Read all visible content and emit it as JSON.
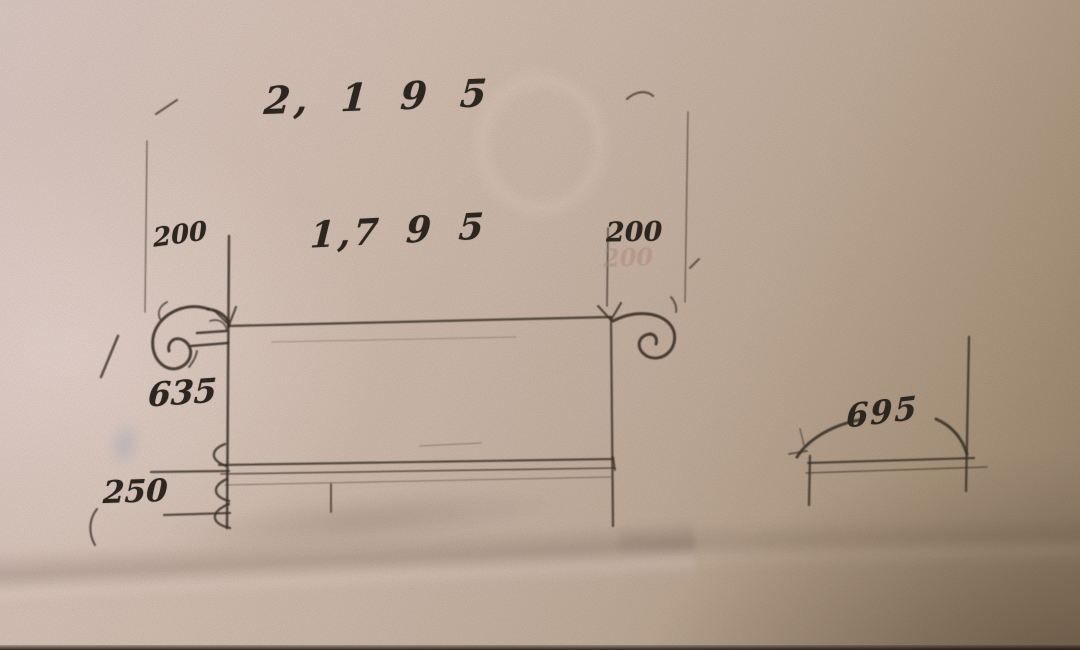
{
  "photo": {
    "type": "hand-drawn pencil sketch of a dimensioned drawing on paper",
    "paper_base_color": "#d2bdae",
    "pencil_color": "#3b322a",
    "ink_color": "#2c2620",
    "smudge_color": "#5c82bc"
  },
  "sketch": {
    "views": {
      "front_elevation": "bench / slab front elevation with overhangs",
      "side_detail": "narrow side profile at lower right"
    },
    "dimensions": {
      "total_width": {
        "value": "2,195",
        "display": "2, 1 9 5"
      },
      "inner_width": {
        "value": "1,795",
        "display": "1,7 9 5"
      },
      "left_offset": {
        "value": "200",
        "display": "200"
      },
      "right_offset": {
        "value": "200",
        "display": "200"
      },
      "right_offset_ghost": {
        "display": "200"
      },
      "height": {
        "value": "635",
        "display": "635"
      },
      "base_height": {
        "value": "250",
        "display": "250"
      },
      "side_width": {
        "value": "695",
        "display": "695"
      }
    }
  }
}
